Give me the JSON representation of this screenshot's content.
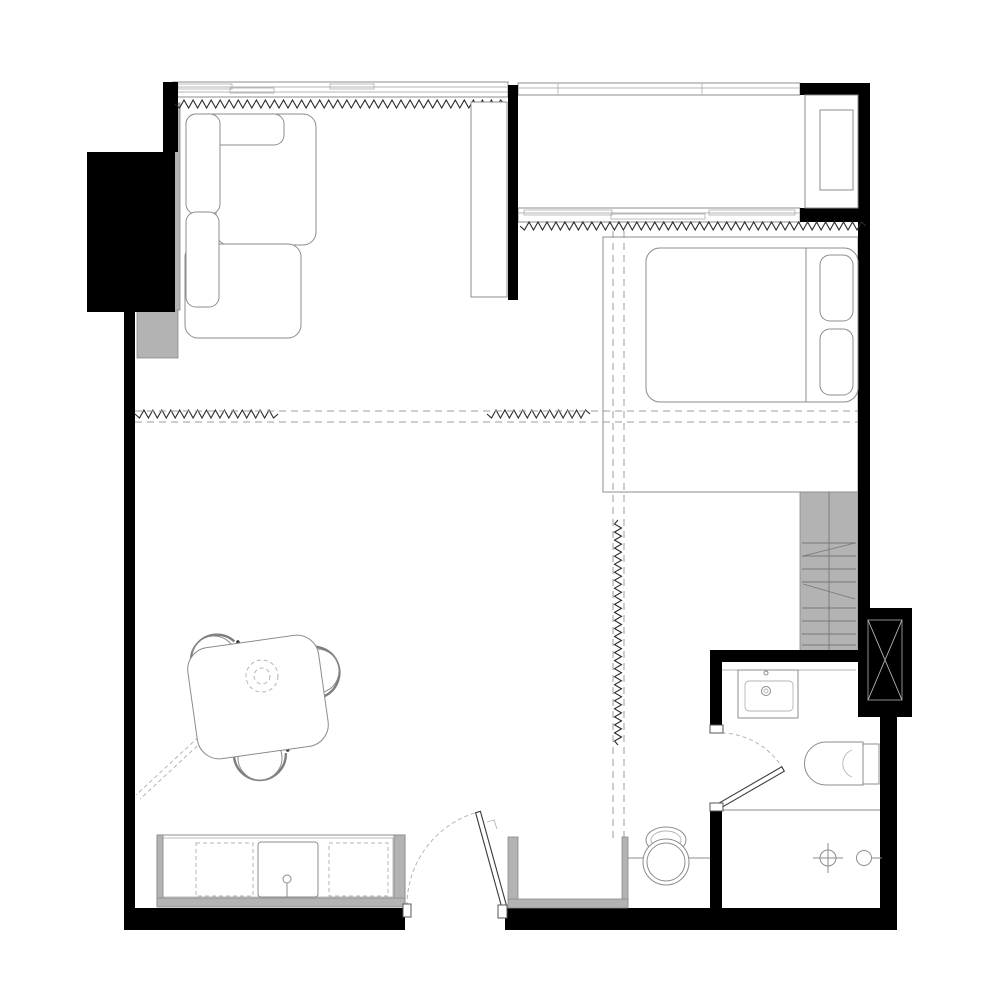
{
  "meta": {
    "type": "architectural-floor-plan",
    "subject": "studio-apartment-plan-view",
    "canvas": {
      "width": 1000,
      "height": 1000
    },
    "text_labels": []
  },
  "palette": {
    "bg": "#ffffff",
    "wall": "#000000",
    "gray_fill": "#b3b3b3",
    "line": "#8c8c8c",
    "line_light": "#b5b5b5",
    "dash": "#9e9e9e",
    "zigzag": "#2b2b2b",
    "leaf": "#3a3a3a"
  },
  "zones": [
    {
      "name": "living-area",
      "position": "top-left"
    },
    {
      "name": "sleeping-area",
      "position": "top-right"
    },
    {
      "name": "balcony",
      "position": "top-right-strip"
    },
    {
      "name": "dining-area",
      "position": "center-left"
    },
    {
      "name": "kitchen",
      "position": "bottom-left"
    },
    {
      "name": "entry-hall",
      "position": "bottom-center"
    },
    {
      "name": "bathroom",
      "position": "bottom-right"
    }
  ],
  "symbols": [
    {
      "name": "sectional-sofa",
      "kind": "furniture"
    },
    {
      "name": "tall-cabinet",
      "kind": "furniture"
    },
    {
      "name": "double-bed-with-pillows",
      "kind": "furniture"
    },
    {
      "name": "wardrobe-platform",
      "kind": "furniture"
    },
    {
      "name": "dining-table-rotated",
      "kind": "furniture"
    },
    {
      "name": "dining-chair",
      "kind": "furniture",
      "count": 3
    },
    {
      "name": "ceiling-lamp-dashed",
      "kind": "fixture"
    },
    {
      "name": "kitchen-counter-with-sink",
      "kind": "casework"
    },
    {
      "name": "under-counter-appliance-dashed",
      "kind": "casework",
      "count": 2
    },
    {
      "name": "entry-closet-niche",
      "kind": "casework"
    },
    {
      "name": "desk-with-stool",
      "kind": "furniture"
    },
    {
      "name": "loft-ladder-block",
      "kind": "casework"
    },
    {
      "name": "ac-condenser-unit",
      "kind": "equipment"
    },
    {
      "name": "ventilation-shaft-crossed",
      "kind": "structure"
    },
    {
      "name": "washbasin",
      "kind": "sanitary"
    },
    {
      "name": "toilet",
      "kind": "sanitary"
    },
    {
      "name": "shower-drain",
      "kind": "sanitary"
    },
    {
      "name": "shower-head",
      "kind": "sanitary"
    },
    {
      "name": "entrance-door-swing",
      "kind": "door"
    },
    {
      "name": "bathroom-door-swing",
      "kind": "door"
    },
    {
      "name": "window-band-living",
      "kind": "window"
    },
    {
      "name": "window-band-bedroom",
      "kind": "window"
    },
    {
      "name": "balcony-balustrade",
      "kind": "window"
    },
    {
      "name": "insulation-zigzag-line",
      "kind": "annotation",
      "count": 5
    },
    {
      "name": "sliding-partition-dashed-track",
      "kind": "annotation",
      "count": 2
    }
  ]
}
